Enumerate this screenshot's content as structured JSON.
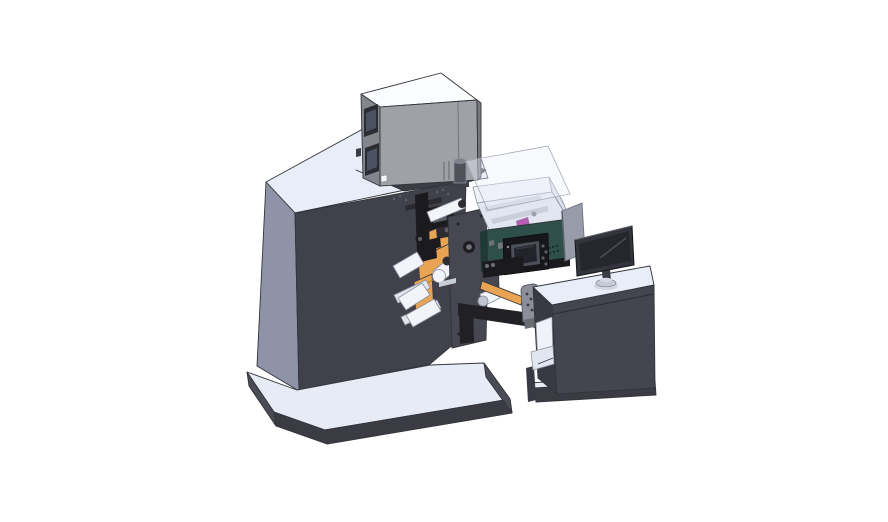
{
  "canvas": {
    "background": "#ffffff"
  },
  "scene": {
    "type": "3d-cad-render",
    "subject": "label-press-machine-with-operator-desk",
    "parts": [
      "electrical-cabinet",
      "exhaust-pipe",
      "press-main-body",
      "print-mechanism",
      "label-web",
      "web-rollers",
      "unwind-side-plate",
      "web-guide-bracket",
      "connecting-beam",
      "inspection-enclosure",
      "enclosure-glass-lid",
      "hmi-panel",
      "operator-desk",
      "desk-monitor",
      "divider-panel",
      "machine-base-plate",
      "desk-base-plate"
    ]
  },
  "colors": {
    "bg": "#ffffff",
    "edge": "#33343b",
    "edge_light": "#8d919e",
    "top_face": "#e9edf7",
    "top_face_shade": "#dce2ef",
    "machine_front": "#41414b",
    "machine_left": "#8f93a7",
    "deck": "#3c3c45",
    "cab_top": "#fbfcfe",
    "cab_left": "#84868d",
    "cab_front": "#9fa1a6",
    "cab_right": "#77797f",
    "cab_window": "#4a5160",
    "cab_window_frame": "#2b2d33",
    "pipe": "#50525a",
    "pipe_cap": "#80828a",
    "orange": "#e8a452",
    "orange_dark": "#b97b2e",
    "roller": "#f2f4f9",
    "roller_shade": "#c2c6d2",
    "roller_cap": "#2c2c32",
    "mech_black": "#1a1a1f",
    "mech_dark": "#2b2b31",
    "mech_gray": "#5c5e66",
    "plate": "#474751",
    "plate_dark": "#32323a",
    "teal": "#2e4f4a",
    "teal_dark": "#1f3a36",
    "interior_white": "#eff2f8",
    "interior_floor": "#e1e6f0",
    "interior_wall": "#d9deea",
    "bar_light": "#c9cedb",
    "purple": "#a963a9",
    "magenta": "#cf52c4",
    "hmi_body": "#17171b",
    "hmi_frame": "#4d5059",
    "hmi_screen": "#23242b",
    "hmi_btn": "#5a5d64",
    "beam_black": "#202025",
    "bracket_gray": "#8c8f9a",
    "base_top": "#e7ebf6",
    "base_front": "#3b3b44",
    "base_side": "#4b4b55",
    "desk_front": "#45454f",
    "desk_left": "#393943",
    "desk_top": "#e9edf7",
    "divider": "#979baa",
    "monitor_frame": "#34353c",
    "monitor_screen": "#26272e",
    "monitor_line": "#51535b",
    "stand_base": "#c7cbd7",
    "stand_stem": "#3a3b43",
    "glass": "rgba(236,240,250,0.42)",
    "label_light": "#c9cdd7"
  }
}
